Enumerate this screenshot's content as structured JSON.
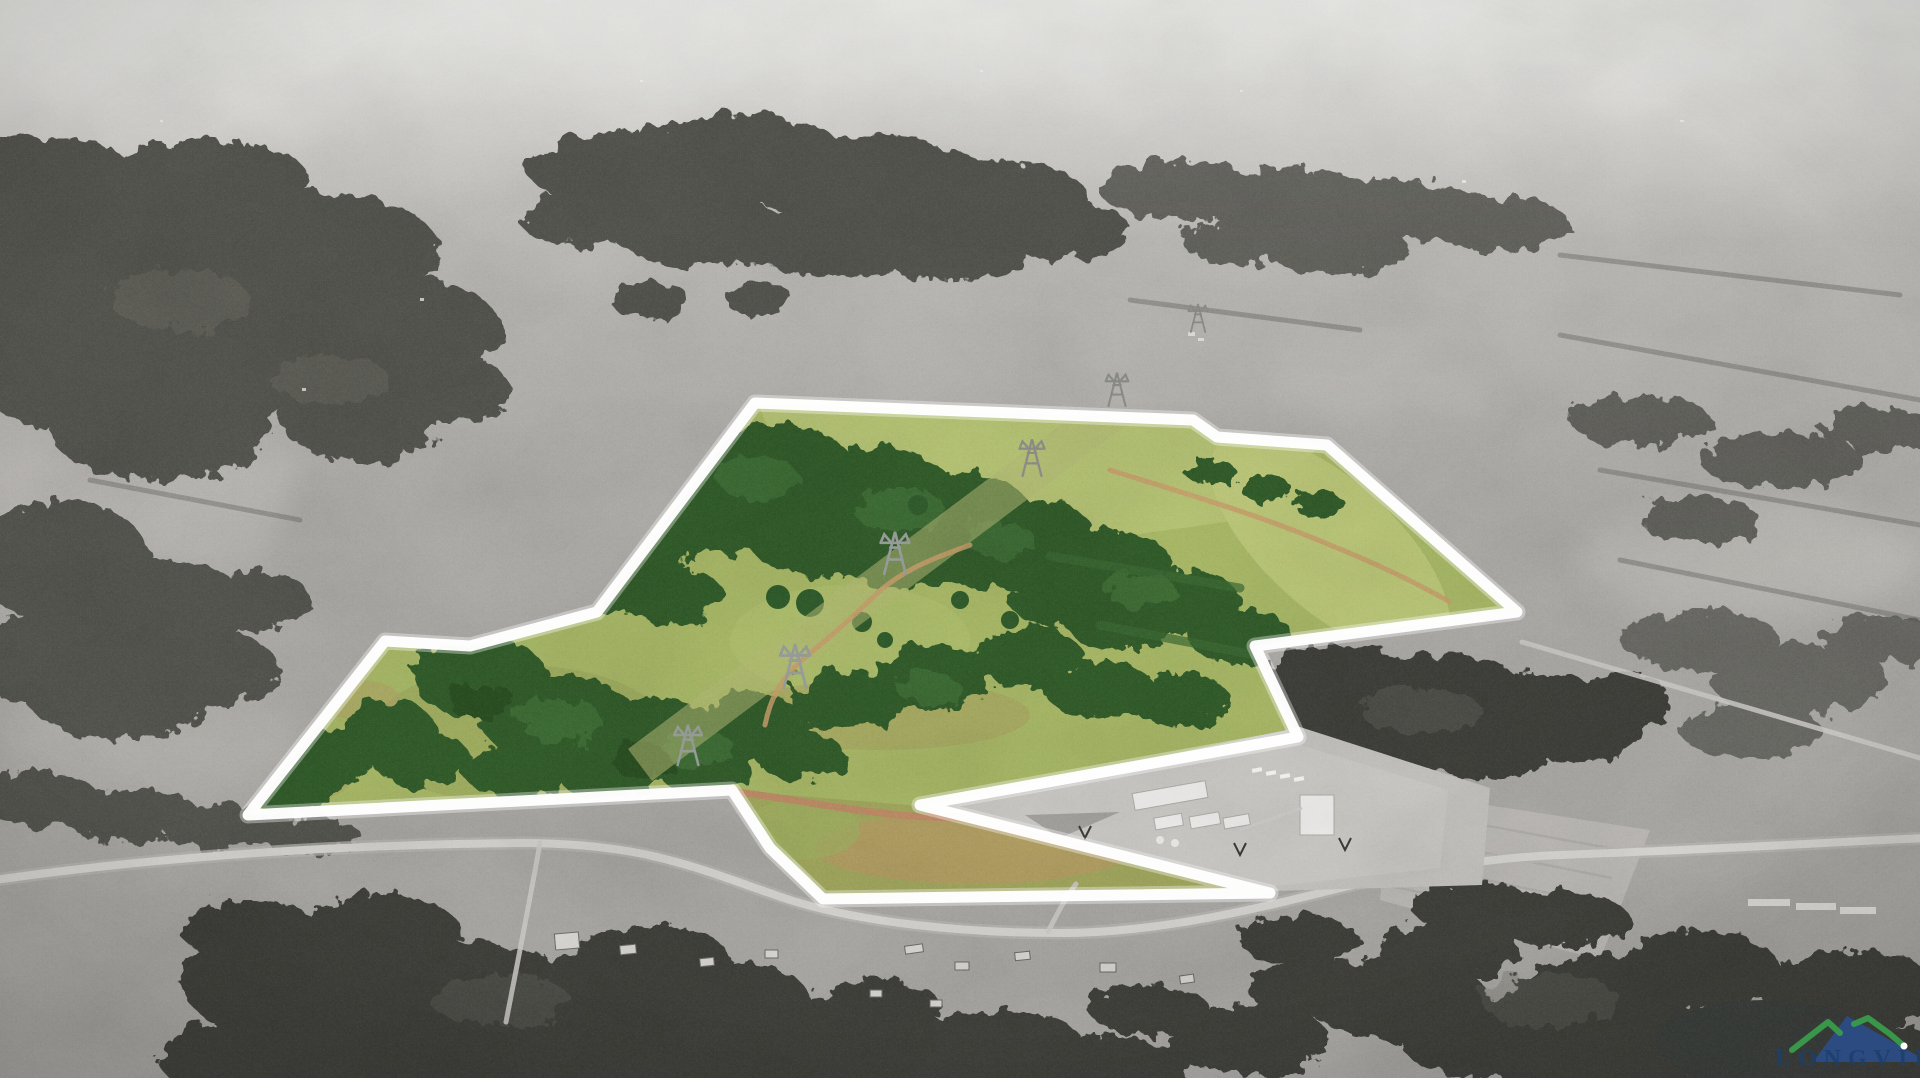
{
  "scene": {
    "boundary": {
      "points": "755,403 1193,420 1217,437 1327,445 1517,612 1255,646 1298,737 920,805 1270,893 823,899 770,848 732,790 248,815 385,641 470,646 597,612",
      "color": "#ffffff",
      "stroke_width": 11
    },
    "parcel": {
      "pasture_color": "#a9b967",
      "pasture_light_color": "#b9c678",
      "forest_color": "#305c2c",
      "forest_highlight_color": "#4d7d3e",
      "bottom_field_points": "737,791 920,806 1266,889 826,896 744,800",
      "bottom_field_color": "#a2a85e",
      "dirt_patch_color": "#b59d64"
    },
    "outside": {
      "field_color": "#b2b0ac",
      "forest_color": "#55554f",
      "forest_dark_color": "#41413a",
      "road_color": "#d7d5d1",
      "haze_color": "#e4e4e1"
    },
    "power_line": {
      "corridor_points": "628,749 1148,359 1172,391 652,781",
      "corridor_color": "#b5bc74",
      "towers": [
        {
          "transform": "translate(688,742) scale(1.15)"
        },
        {
          "transform": "translate(795,663) scale(1.25)"
        },
        {
          "transform": "translate(895,550) scale(1.2)"
        },
        {
          "transform": "translate(1032,455) scale(1.05)"
        },
        {
          "transform": "translate(1117,387) scale(0.95)"
        },
        {
          "transform": "translate(1198,316) scale(0.8)"
        }
      ]
    },
    "roads": {
      "main_road_path": "M-5,880 C120,862 300,845 520,843 C650,843 700,870 790,900 C860,922 960,933 1060,933 C1160,933 1260,908 1340,888 C1420,868 1500,857 1560,855 C1700,850 1820,843 1925,838",
      "branch_road_path": "M540,843 C530,900 518,960 506,1022",
      "right_road_path": "M1522,642 L1920,758",
      "entrance_path": "M1048,932 C1058,912 1066,897 1076,884"
    },
    "trails": {
      "trail1": "M970,545 C930,560 900,570 870,600 C845,625 825,640 800,662 C780,680 770,700 765,725",
      "trail2": "M1110,470 C1180,492 1260,515 1330,545 C1380,565 1420,585 1450,602",
      "dirt_road": "M737,792 C800,800 830,808 900,815 C980,823 1040,812 1100,802 C1140,795 1170,790 1195,788",
      "trail_color": "#c9a06b",
      "dirt_road_color": "#c28a68"
    },
    "facility": {
      "pad_points": "925,806 1300,727 1490,788 1482,885 1272,891",
      "pad_color": "#c6c4c0",
      "building_color": "#f0efed"
    },
    "pond": {
      "color": "#3c403d"
    },
    "watermark": {
      "text": "LONGVIEW",
      "text_color": "#1d3f6b",
      "ridge_green": "#3aa04c",
      "mountain_blue": "#2a4f8e",
      "dot_color": "#ffffff"
    }
  }
}
